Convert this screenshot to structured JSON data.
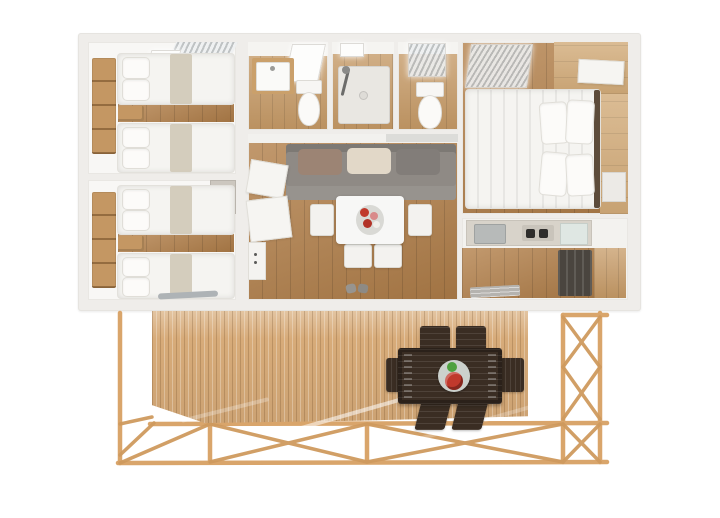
{
  "scene": {
    "type": "3d-floorplan-render",
    "label": "mobile-home-floor-plan-with-raised-terrace",
    "background": "#ffffff"
  },
  "palette": {
    "outer_wall": "#efedea",
    "interior_wall": "#f8f7f5",
    "interior_wood_floor": "#b3804a",
    "deck_wood": "#d7ab79",
    "frame_timber": "#d9a56b",
    "sofa_gray": "#8f8a85",
    "cushion_taupe": "#9c8474",
    "cushion_cream": "#e2d8c8",
    "cushion_gray": "#827d79",
    "bedding_white": "#f5f4f1",
    "counter_greige": "#d8d3ca",
    "outdoor_furniture_dark": "#3a2d23",
    "accent_red": "#c0392c",
    "accent_green": "#4ea13e"
  },
  "floorplan": {
    "rooms": [
      {
        "name": "bedroom-left-top",
        "furniture": [
          "wall-shelf",
          "single-bed",
          "single-bed",
          "nightstand",
          "skylight-window-blinds"
        ]
      },
      {
        "name": "bedroom-left-bottom",
        "furniture": [
          "wall-shelf",
          "single-bed",
          "single-bed",
          "nightstand",
          "wardrobe"
        ]
      },
      {
        "name": "bathroom",
        "furniture": [
          "washbasin",
          "toilet",
          "skylight-window"
        ]
      },
      {
        "name": "shower-room",
        "furniture": [
          "shower-tray",
          "shower-head",
          "skylight-window"
        ]
      },
      {
        "name": "wc",
        "furniture": [
          "toilet",
          "skylight-window"
        ]
      },
      {
        "name": "living-dining-room",
        "furniture": [
          "sofa",
          "cushions",
          "dining-table",
          "flower-centerpiece",
          "white-chairs",
          "open-doors",
          "shoes"
        ]
      },
      {
        "name": "master-bedroom",
        "furniture": [
          "double-bed",
          "pillows",
          "wardrobe",
          "window-blinds"
        ]
      },
      {
        "name": "kitchen",
        "furniture": [
          "countertop",
          "sink",
          "cooktop",
          "fridge",
          "doormat"
        ]
      }
    ]
  },
  "terrace": {
    "name": "raised-timber-terrace",
    "structure": [
      "vertical-plank-deck",
      "timber-post-frame",
      "cross-bracing"
    ],
    "furniture": [
      {
        "name": "outdoor-dining-table",
        "count": 1
      },
      {
        "name": "outdoor-chair",
        "count": 6
      },
      {
        "name": "fruit-plate",
        "count": 1
      }
    ]
  }
}
